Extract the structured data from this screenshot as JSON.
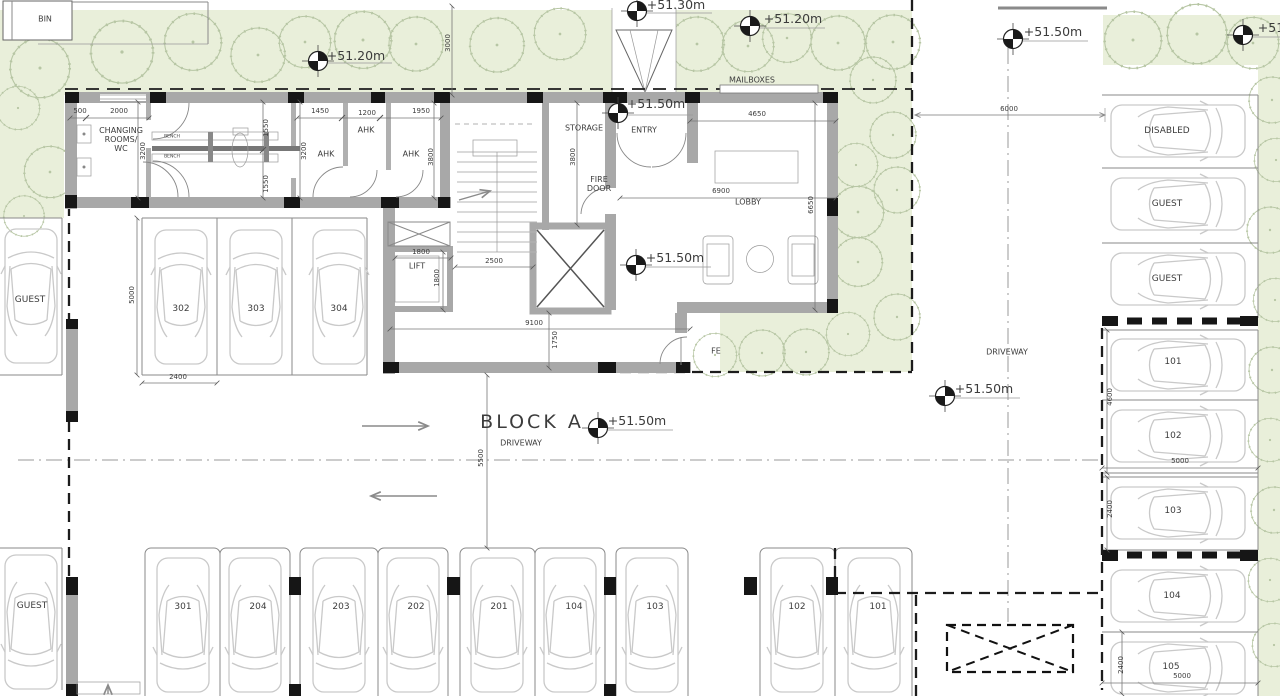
{
  "drawing_type": "architectural ground floor / parking site plan",
  "block_title": "BLOCK A",
  "colors": {
    "landscape": "#e9efda",
    "tree_stroke": "#b7c6a4",
    "wall_gray": "#a8a8a8",
    "column_black": "#161616",
    "line_gray": "#8a8a8a",
    "car_outline": "#c9c9c9",
    "text_dark": "#3c3c3c",
    "block_label_gray": "#c3c3c3"
  },
  "labels": {
    "rooms": [
      {
        "name": "bin-store",
        "text": "BIN",
        "x": 45,
        "y": 19
      },
      {
        "name": "changing-rooms-wc",
        "text": "CHANGING\nROOMS/\nWC",
        "x": 121,
        "y": 140,
        "cls": "left"
      },
      {
        "name": "ahk-1",
        "text": "AHK",
        "x": 326,
        "y": 154
      },
      {
        "name": "ahk-2",
        "text": "AHK",
        "x": 366,
        "y": 130
      },
      {
        "name": "ahk-3",
        "text": "AHK",
        "x": 411,
        "y": 154
      },
      {
        "name": "storage",
        "text": "STORAGE",
        "x": 584,
        "y": 128
      },
      {
        "name": "entry",
        "text": "ENTRY",
        "x": 644,
        "y": 130
      },
      {
        "name": "fire-door",
        "text": "FIRE\nDOOR",
        "x": 599,
        "y": 184
      },
      {
        "name": "lobby",
        "text": "LOBBY",
        "x": 748,
        "y": 202
      },
      {
        "name": "lift",
        "text": "LIFT",
        "x": 417,
        "y": 266
      },
      {
        "name": "mailboxes",
        "text": "MAILBOXES",
        "x": 752,
        "y": 80
      },
      {
        "name": "fire-exit",
        "text": "FE",
        "x": 716,
        "y": 351
      },
      {
        "name": "bench-1",
        "text": "BENCH",
        "x": 172,
        "y": 137,
        "cls": "tiny"
      },
      {
        "name": "bench-2",
        "text": "BENCH",
        "x": 172,
        "y": 157,
        "cls": "tiny"
      },
      {
        "name": "driveway-main",
        "text": "DRIVEWAY",
        "x": 521,
        "y": 443
      },
      {
        "name": "driveway-right",
        "text": "DRIVEWAY",
        "x": 1007,
        "y": 352
      },
      {
        "name": "block-a-title",
        "text": "BLOCK A",
        "x": 532,
        "y": 423,
        "cls": "blocka"
      }
    ],
    "parking": [
      {
        "name": "stall-guest-left-top",
        "text": "GUEST",
        "x": 30,
        "y": 300
      },
      {
        "name": "stall-302",
        "text": "302",
        "x": 181,
        "y": 309
      },
      {
        "name": "stall-303",
        "text": "303",
        "x": 256,
        "y": 309
      },
      {
        "name": "stall-304",
        "text": "304",
        "x": 339,
        "y": 309
      },
      {
        "name": "stall-disabled",
        "text": "DISABLED",
        "x": 1167,
        "y": 131
      },
      {
        "name": "stall-guest-right-1",
        "text": "GUEST",
        "x": 1167,
        "y": 204
      },
      {
        "name": "stall-guest-right-2",
        "text": "GUEST",
        "x": 1167,
        "y": 279
      },
      {
        "name": "stall-101-right",
        "text": "101",
        "x": 1173,
        "y": 362
      },
      {
        "name": "stall-102-right",
        "text": "102",
        "x": 1173,
        "y": 436
      },
      {
        "name": "stall-103-right",
        "text": "103",
        "x": 1173,
        "y": 511
      },
      {
        "name": "stall-104-right",
        "text": "104",
        "x": 1172,
        "y": 596
      },
      {
        "name": "stall-105-right",
        "text": "105",
        "x": 1171,
        "y": 667
      },
      {
        "name": "stall-guest-bottom",
        "text": "GUEST",
        "x": 32,
        "y": 606
      },
      {
        "name": "stall-301",
        "text": "301",
        "x": 183,
        "y": 607
      },
      {
        "name": "stall-204",
        "text": "204",
        "x": 258,
        "y": 607
      },
      {
        "name": "stall-203",
        "text": "203",
        "x": 341,
        "y": 607
      },
      {
        "name": "stall-202",
        "text": "202",
        "x": 416,
        "y": 607
      },
      {
        "name": "stall-201",
        "text": "201",
        "x": 499,
        "y": 607
      },
      {
        "name": "stall-104-bottom",
        "text": "104",
        "x": 574,
        "y": 607
      },
      {
        "name": "stall-103-bottom",
        "text": "103",
        "x": 655,
        "y": 607
      },
      {
        "name": "stall-102-bottom",
        "text": "102",
        "x": 797,
        "y": 607
      },
      {
        "name": "stall-101-bottom",
        "text": "101",
        "x": 878,
        "y": 607
      }
    ],
    "elevation_markers": [
      {
        "name": "level-51-20-topleft",
        "text": "+51.20m",
        "x": 356,
        "y": 56
      },
      {
        "name": "level-51-30-top",
        "text": "+51.30m",
        "x": 676,
        "y": 5
      },
      {
        "name": "level-51-20-topmid",
        "text": "+51.20m",
        "x": 793,
        "y": 19
      },
      {
        "name": "level-51-20-topright",
        "text": "+51.20m",
        "x": 1287,
        "y": 28
      },
      {
        "name": "level-51-50-driveway-top",
        "text": "+51.50m",
        "x": 1053,
        "y": 32
      },
      {
        "name": "level-51-50-entry",
        "text": "+51.50m",
        "x": 656,
        "y": 104
      },
      {
        "name": "level-51-50-lobby",
        "text": "+51.50m",
        "x": 675,
        "y": 258
      },
      {
        "name": "level-51-50-blocka",
        "text": "+51.50m",
        "x": 637,
        "y": 421
      },
      {
        "name": "level-51-50-driveway-right",
        "text": "+51.50m",
        "x": 984,
        "y": 389
      }
    ],
    "dimensions": [
      {
        "name": "dim-500",
        "text": "500",
        "x": 80,
        "y": 111
      },
      {
        "name": "dim-2000",
        "text": "2000",
        "x": 119,
        "y": 111
      },
      {
        "name": "dim-1450",
        "text": "1450",
        "x": 320,
        "y": 111
      },
      {
        "name": "dim-1200",
        "text": "1200",
        "x": 367,
        "y": 113
      },
      {
        "name": "dim-1950",
        "text": "1950",
        "x": 421,
        "y": 111
      },
      {
        "name": "dim-3000",
        "text": "3000",
        "x": 448,
        "y": 43,
        "rot": true
      },
      {
        "name": "dim-3200-a",
        "text": "3200",
        "x": 143,
        "y": 151,
        "rot": true
      },
      {
        "name": "dim-1550-a",
        "text": "1550",
        "x": 266,
        "y": 128,
        "rot": true
      },
      {
        "name": "dim-1550-b",
        "text": "1550",
        "x": 266,
        "y": 184,
        "rot": true
      },
      {
        "name": "dim-3200-b",
        "text": "3200",
        "x": 304,
        "y": 151,
        "rot": true
      },
      {
        "name": "dim-3800-a",
        "text": "3800",
        "x": 431,
        "y": 157,
        "rot": true
      },
      {
        "name": "dim-3800-b",
        "text": "3800",
        "x": 573,
        "y": 157,
        "rot": true
      },
      {
        "name": "dim-4650",
        "text": "4650",
        "x": 757,
        "y": 114
      },
      {
        "name": "dim-6900",
        "text": "6900",
        "x": 721,
        "y": 191
      },
      {
        "name": "dim-6650",
        "text": "6650",
        "x": 811,
        "y": 205,
        "rot": true
      },
      {
        "name": "dim-1800-a",
        "text": "1800",
        "x": 421,
        "y": 252
      },
      {
        "name": "dim-1800-b",
        "text": "1800",
        "x": 437,
        "y": 278,
        "rot": true
      },
      {
        "name": "dim-2500",
        "text": "2500",
        "x": 494,
        "y": 261
      },
      {
        "name": "dim-9100",
        "text": "9100",
        "x": 534,
        "y": 323
      },
      {
        "name": "dim-1750",
        "text": "1750",
        "x": 555,
        "y": 340,
        "rot": true
      },
      {
        "name": "dim-5000-left",
        "text": "5000",
        "x": 132,
        "y": 295,
        "rot": true
      },
      {
        "name": "dim-2400-left",
        "text": "2400",
        "x": 178,
        "y": 377
      },
      {
        "name": "dim-5500",
        "text": "5500",
        "x": 481,
        "y": 458,
        "rot": true
      },
      {
        "name": "dim-6000",
        "text": "6000",
        "x": 1009,
        "y": 109
      },
      {
        "name": "dim-4600",
        "text": "4600",
        "x": 1110,
        "y": 397,
        "rot": true
      },
      {
        "name": "dim-5000-right1",
        "text": "5000",
        "x": 1180,
        "y": 461
      },
      {
        "name": "dim-2400-right1",
        "text": "2400",
        "x": 1110,
        "y": 509,
        "rot": true
      },
      {
        "name": "dim-2400-right2",
        "text": "2400",
        "x": 1121,
        "y": 665,
        "rot": true
      },
      {
        "name": "dim-5000-right2",
        "text": "5000",
        "x": 1182,
        "y": 676
      }
    ]
  }
}
